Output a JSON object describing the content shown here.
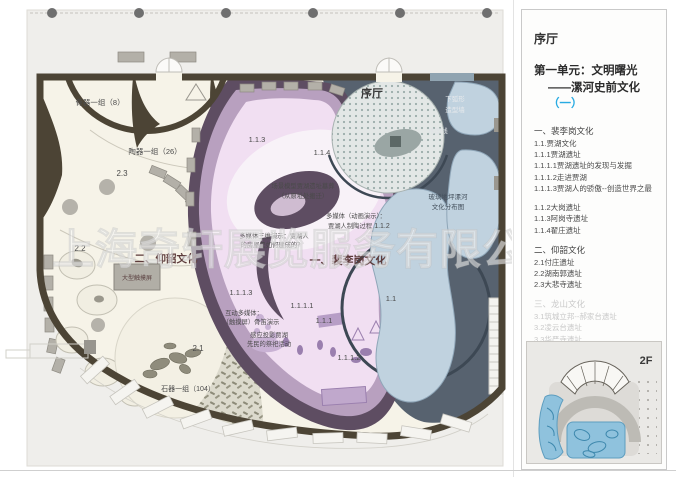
{
  "watermark": {
    "text": "上海奇轩展览服务有限公司"
  },
  "colors": {
    "accent_cyan": "#29abe2",
    "section_label": "#5c3a3a",
    "wall": "#4c4435",
    "slate_zone": "#57626f",
    "pink_zone": "#f1dff2",
    "mauve_dark": "#5e4d62",
    "mauve_mid": "#b8a0bf",
    "blue_shape": "#c0d2df",
    "cream_room": "#f6f3e8",
    "inset_blue": "#8fc2dd"
  },
  "plan": {
    "labels": {
      "bone_group": "骨器一组（8）",
      "pottery_group": "陶器一组（26）",
      "n23": "2.3",
      "n22": "2.2",
      "n21": "2.1",
      "yangshao": "二、仰韶文化",
      "touchscreen": "大型触摸屏",
      "stone_group": "石器一组（104）",
      "foyer": "序厅",
      "arc_wall_1": "下弧形",
      "arc_wall_2": "造型墙",
      "ground_line": "地面线",
      "glass_1": "玻璃地坪漯河",
      "glass_2": "文化分布图",
      "n113": "1.1.3",
      "n114": "1.1.4",
      "scene_model_1": "场景模型贾湖遗址墓葬",
      "scene_model_2": "（从原址处搬迁）",
      "mm_anim_1": "多媒体（动画演示）：",
      "mm_anim_2": "贾湖人制陶过程",
      "n112": "1.1.2",
      "mm_3d_1": "多媒体三维演示：贾湖人",
      "mm_3d_2": "的房屋是如何建成的？",
      "peiligang": "一、裴李岗文化",
      "n1113": "1.1.1.3",
      "interactive_1": "互动多媒体：",
      "interactive_2": "（触摸屏）骨笛演示",
      "n1111": "1.1.1.1",
      "n111": "1.1.1",
      "sensing_1": "感应投影贾湖",
      "sensing_2": "先民的祭祀活动",
      "n1112": "1.1.1.2",
      "n11": "1.1"
    }
  },
  "sidebar": {
    "hall": "序厅",
    "title_line1": "第一单元：文明曙光",
    "title_line2": "——漯河史前文化",
    "title_suffix": "（一）",
    "items": [
      {
        "text": "一、裴李岗文化"
      },
      {
        "text": "1.1.贾湖文化"
      },
      {
        "text": "1.1.1贾湖遗址"
      },
      {
        "text": "1.1.1.1贾湖遗址的发现与发掘"
      },
      {
        "text": "1.1.1.2走进贾湖"
      },
      {
        "text": "1.1.1.3贾湖人的骄傲--创造世界之最"
      },
      {
        "text": "1.1.2大岗遗址"
      },
      {
        "text": "1.1.3阿岗寺遗址"
      },
      {
        "text": "1.1.4翟庄遗址"
      },
      {
        "text": "二、仰韶文化"
      },
      {
        "text": "2.1付庄遗址"
      },
      {
        "text": "2.2湖南郭遗址"
      },
      {
        "text": "2.3大悲寺遗址"
      },
      {
        "text": "三、龙山文化"
      },
      {
        "text": "3.1筑城立邦--郝家台遗址"
      },
      {
        "text": "3.2凌云台遗址"
      },
      {
        "text": "3.3华严寺遗址"
      },
      {
        "text": "3.4漯河市其它龙山文化遗址"
      }
    ],
    "inset_floor": "2F"
  }
}
